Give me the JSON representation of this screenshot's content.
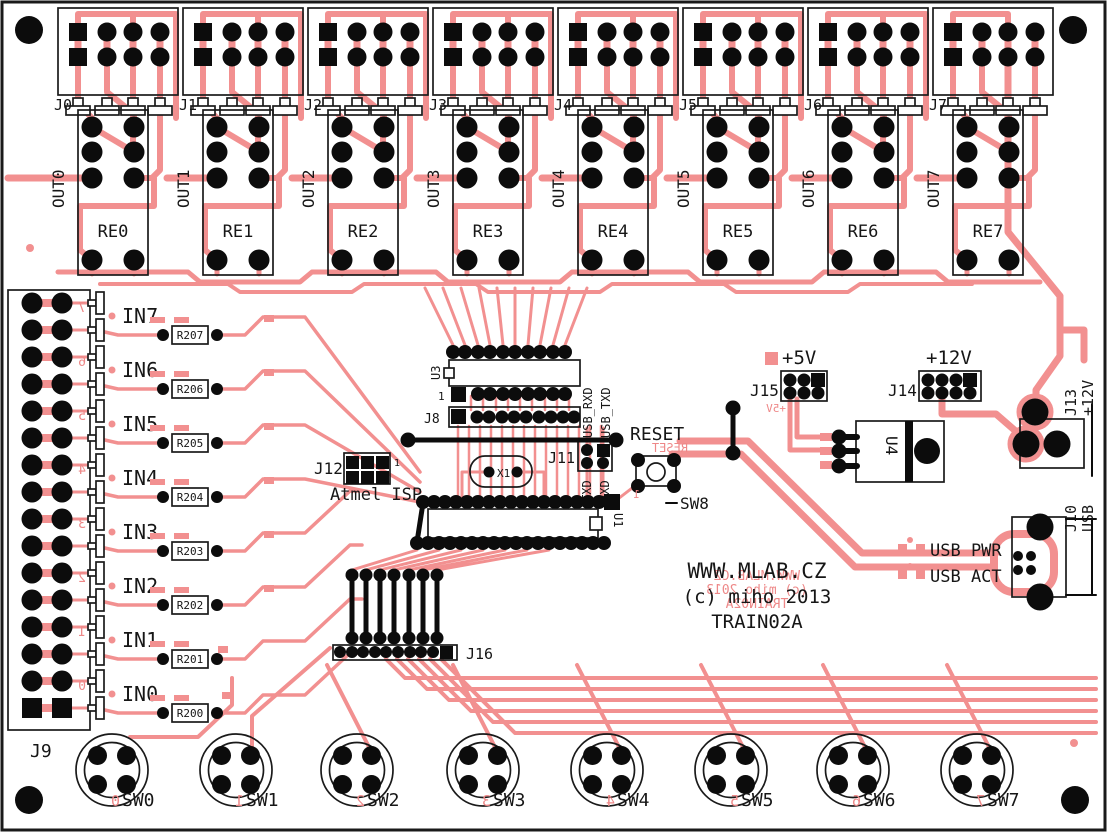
{
  "board": {
    "site_label": "WWW.MLAB.CZ",
    "copyright_label": "(c) miho 2013",
    "name_label": "TRAIN02A",
    "mirror": {
      "site": "WWW.MLAB.CZ",
      "copyright": "(c) miho 2013",
      "name": "TRAIN02A",
      "reset": "RESET",
      "plus5": "+5V",
      "sw8_pin": "1"
    },
    "colors": {
      "trace": "#f29090",
      "silkscreen": "#161616",
      "silk_red": "#ee8888",
      "pad": "#0c0c0c",
      "background": "#ffffff"
    }
  },
  "outputs": [
    {
      "connector": "J0",
      "net": "OUT0",
      "relay": "RE0"
    },
    {
      "connector": "J1",
      "net": "OUT1",
      "relay": "RE1"
    },
    {
      "connector": "J2",
      "net": "OUT2",
      "relay": "RE2"
    },
    {
      "connector": "J3",
      "net": "OUT3",
      "relay": "RE3"
    },
    {
      "connector": "J4",
      "net": "OUT4",
      "relay": "RE4"
    },
    {
      "connector": "J5",
      "net": "OUT5",
      "relay": "RE5"
    },
    {
      "connector": "J6",
      "net": "OUT6",
      "relay": "RE6"
    },
    {
      "connector": "J7",
      "net": "OUT7",
      "relay": "RE7"
    }
  ],
  "inputs": {
    "connector": "J9",
    "rows": [
      {
        "net": "IN7",
        "resistor": "R207",
        "mirror_digit": "7"
      },
      {
        "net": "IN6",
        "resistor": "R206",
        "mirror_digit": "6"
      },
      {
        "net": "IN5",
        "resistor": "R205",
        "mirror_digit": "5"
      },
      {
        "net": "IN4",
        "resistor": "R204",
        "mirror_digit": "4"
      },
      {
        "net": "IN3",
        "resistor": "R203",
        "mirror_digit": "3"
      },
      {
        "net": "IN2",
        "resistor": "R202",
        "mirror_digit": "2"
      },
      {
        "net": "IN1",
        "resistor": "R201",
        "mirror_digit": "1"
      },
      {
        "net": "IN0",
        "resistor": "R200",
        "mirror_digit": "0"
      }
    ]
  },
  "switches": [
    {
      "label": "SW0",
      "mirror_digit": "0"
    },
    {
      "label": "SW1",
      "mirror_digit": "1"
    },
    {
      "label": "SW2",
      "mirror_digit": "2"
    },
    {
      "label": "SW3",
      "mirror_digit": "3"
    },
    {
      "label": "SW4",
      "mirror_digit": "4"
    },
    {
      "label": "SW5",
      "mirror_digit": "5"
    },
    {
      "label": "SW6",
      "mirror_digit": "6"
    },
    {
      "label": "SW7",
      "mirror_digit": "7"
    }
  ],
  "logic": {
    "u3": "U3",
    "u3_pin1": "1",
    "j8": "J8",
    "u1": "U1",
    "x1": "X1",
    "j11": "J11",
    "txd": "TXD",
    "rxd": "RXD",
    "usb_rxd": "USB_RXD",
    "usb_txd": "USB_TXD",
    "j12": "J12",
    "j12_pin1": "1",
    "isp": "Atmel ISP",
    "reset": "RESET",
    "sw8": "SW8",
    "j16": "J16"
  },
  "power": {
    "plus5": "+5V",
    "j15": "J15",
    "plus12": "+12V",
    "j14": "J14",
    "u4": "U4",
    "j13": "J13",
    "j13_net": "+12V"
  },
  "usb": {
    "j10": "J10",
    "j10_net": "USB",
    "pwr": "USB PWR",
    "act": "USB ACT"
  }
}
